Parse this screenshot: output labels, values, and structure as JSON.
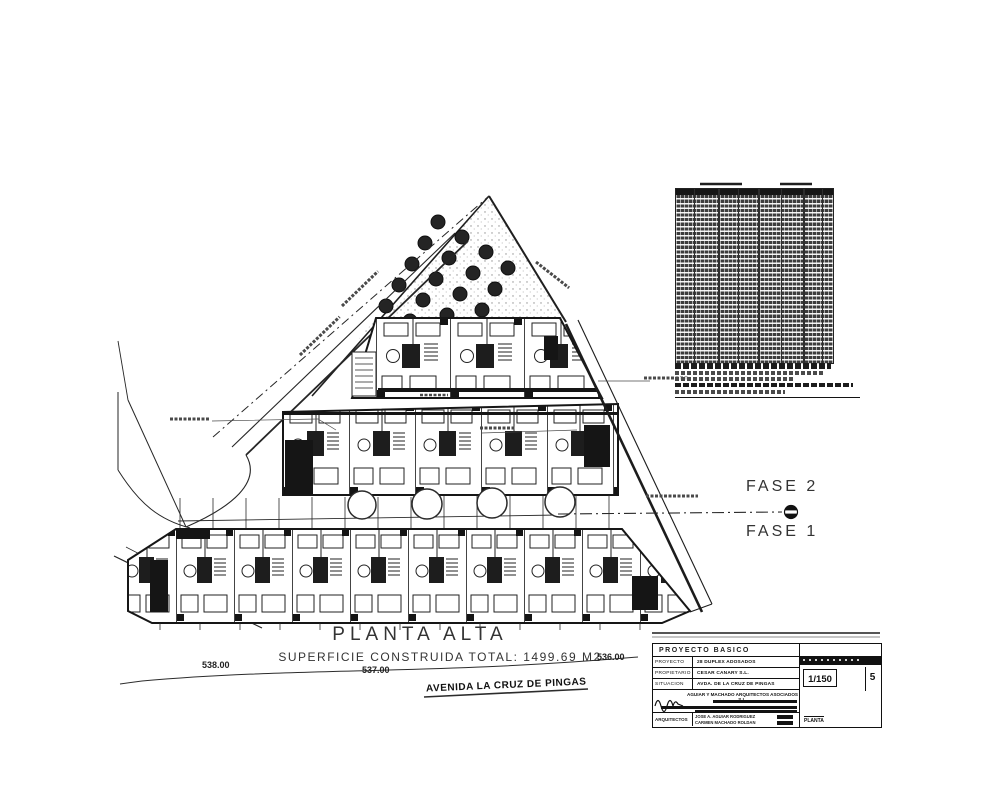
{
  "drawing": {
    "title": "PLANTA ALTA",
    "area_note": "SUPERFICIE CONSTRUIDA TOTAL: 1499.69 M2",
    "fase2": "FASE 2",
    "fase1": "FASE 1",
    "level_538": "538.00",
    "level_537": "537.00",
    "level_536": "536.00",
    "street_name": "AVENIDA LA CRUZ DE PINGAS"
  },
  "title_block": {
    "header": "PROYECTO BASICO",
    "project_label": "PROYECTO",
    "project_value": "28 DUPLEX ADOSADOS",
    "owner_label": "PROPIETARIO",
    "owner_value": "CESAR CANARY S.L.",
    "location_label": "SITUACION",
    "location_value": "AVDA. DE LA CRUZ DE PINGAS",
    "firm": "AGUIAR Y MACHADO ARQUITECTOS ASOCIADOS S.L.",
    "architects_label": "ARQUITECTOS",
    "architect_line1": "JOSE A. AGUIAR RODRIGUEZ",
    "architect_line2": "CARMEN MACHADO ROLDAN",
    "scale_value": "1/150",
    "sheet_number": "5",
    "sheet_word": "PLANTA"
  }
}
